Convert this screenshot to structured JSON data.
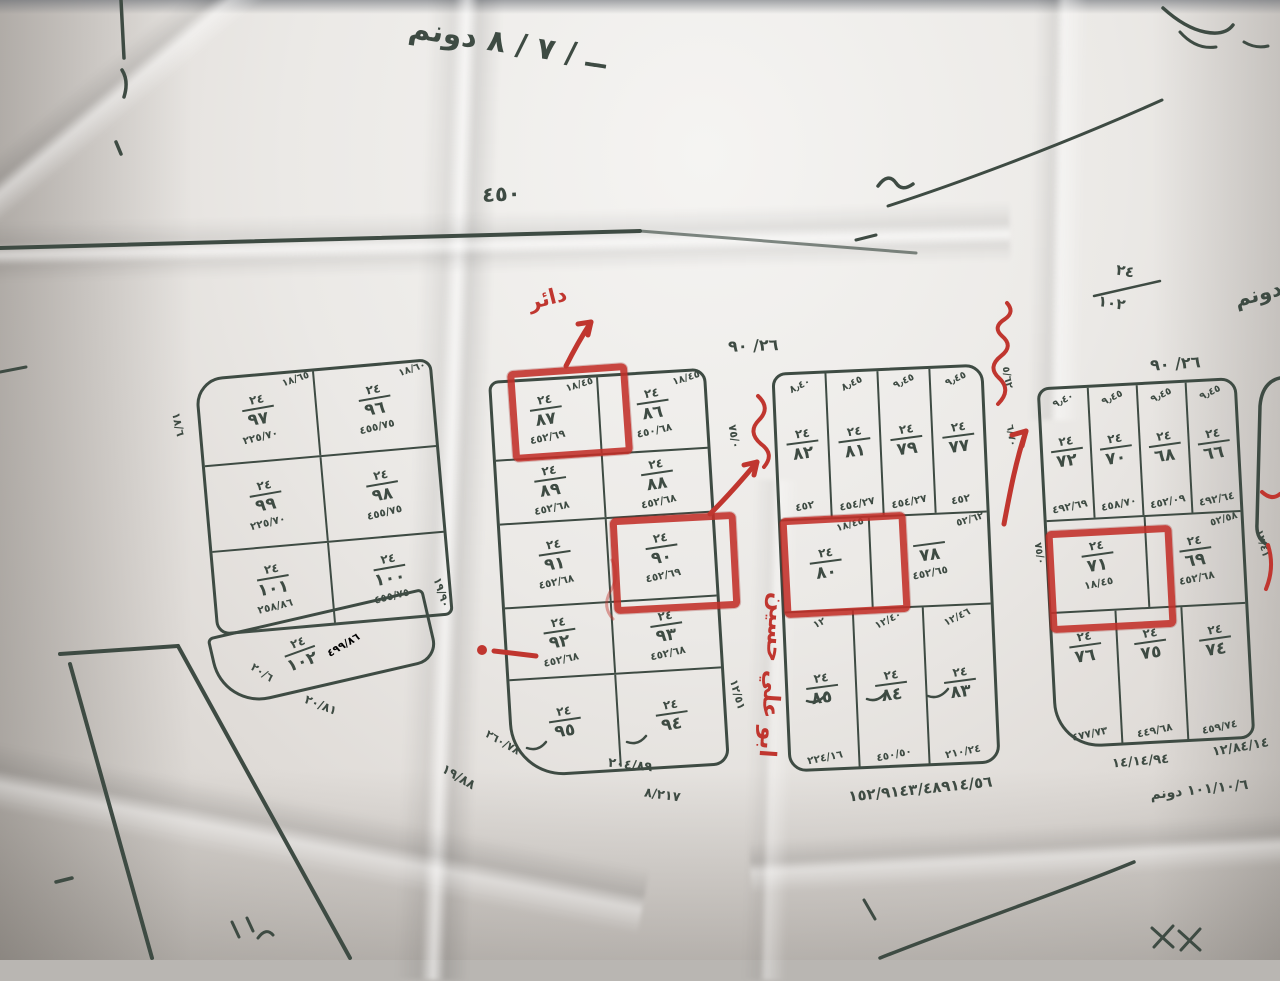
{
  "photo": {
    "paper_color": "#ebe9e6",
    "ink_color": "#3e4b43",
    "marker_color": "#c0362f"
  },
  "top_notes": {
    "dunum_note": "ــ / ٧ / ٨ دونم",
    "road_number": "٤٥٠",
    "corner_fraction_top": "٢٤",
    "corner_fraction_bottom": "١٠٢",
    "dunum_right": "دونم"
  },
  "red_notes": {
    "daer": "دائر",
    "owner_name": "ابو علي حسين"
  },
  "blocks": {
    "a": {
      "cells": [
        {
          "top": "١٨/٦٥",
          "w": "٢٤",
          "n": "٩٧",
          "area": "٢٢٥/٧٠"
        },
        {
          "top": "١٨/٦٠",
          "w": "٢٤",
          "n": "٩٦",
          "area": "٤٥٥/٧٥"
        },
        {
          "top": "",
          "w": "٢٤",
          "n": "٩٩",
          "area": "٢٢٥/٧٠"
        },
        {
          "top": "",
          "w": "٢٤",
          "n": "٩٨",
          "area": "٤٥٥/٧٥"
        },
        {
          "top": "",
          "w": "٢٤",
          "n": "١٠١",
          "area": "٢٥٨/٨٦"
        },
        {
          "top": "",
          "w": "٢٤",
          "n": "١٠٠",
          "area": "٤٥٥/٧٥"
        }
      ],
      "bottom_cell": {
        "w": "٢٤",
        "n": "١٠٢",
        "area": "٤٩٩/٨٦"
      },
      "margins": {
        "left_v": "١٨/٦",
        "right_v": "١٩/٩٠",
        "bottom_1": "٢٠/٦",
        "bottom_2": "٢٠/٨١"
      }
    },
    "b": {
      "cells": [
        {
          "top": "١٨/٤٥",
          "w": "٢٤",
          "n": "٨٧",
          "area": "٤٥٢/٦٩"
        },
        {
          "top": "١٨/٤٥",
          "w": "٢٤",
          "n": "٨٦",
          "area": "٤٥٠/٦٨"
        },
        {
          "top": "",
          "w": "٢٤",
          "n": "٨٩",
          "area": "٤٥٢/٦٨"
        },
        {
          "top": "",
          "w": "٢٤",
          "n": "٨٨",
          "area": "٤٥٢/٦٨"
        },
        {
          "top": "",
          "w": "٢٤",
          "n": "٩١",
          "area": "٤٥٢/٦٨"
        },
        {
          "top": "",
          "w": "٢٤",
          "n": "٩٠",
          "area": "٤٥٢/٦٩"
        },
        {
          "top": "",
          "w": "٢٤",
          "n": "٩٢",
          "area": "٤٥٢/٦٨"
        },
        {
          "top": "",
          "w": "٢٤",
          "n": "٩٣",
          "area": "٤٥٢/٦٨"
        },
        {
          "top": "",
          "w": "٢٤",
          "n": "٩٥",
          "area": ""
        },
        {
          "top": "",
          "w": "٢٤",
          "n": "٩٤",
          "area": ""
        }
      ],
      "margins": {
        "right_top": "٧٥/٠",
        "right_bottom": "١٢/٥١",
        "bottom_left_1": "٢٦٠/٧٨",
        "bottom_left_2": "١٩/٨٨",
        "bottom_1": "٢٠٤/٨٩",
        "bottom_2": "٨/٢١٧"
      }
    },
    "c": {
      "title": "٢٦/ ٩٠",
      "top_cols": [
        {
          "top": "٨٫٤٠",
          "w": "٢٤",
          "n": "٨٢",
          "area": "٤٥٢"
        },
        {
          "top": "٨٫٤٥",
          "w": "٢٤",
          "n": "٨١",
          "area": "٤٥٤/٢٧"
        },
        {
          "top": "٩٫٤٥",
          "w": "٢٤",
          "n": "٧٩",
          "area": "٤٥٤/٢٧"
        },
        {
          "top": "٩٫٤٥",
          "w": "٢٤",
          "n": "٧٧",
          "area": "٤٥٢"
        }
      ],
      "mid": [
        {
          "top": "١٨/٤٥",
          "w": "٢٤",
          "n": "٨٠",
          "area": ""
        },
        {
          "top": "٥٢/٦٢",
          "w": "",
          "n": "٧٨",
          "area": "٤٥٢/٦٥"
        }
      ],
      "bottom_cols": [
        {
          "top": "١٢",
          "w": "٢٤",
          "n": "٨٥",
          "area": "٢٢٤/١٦"
        },
        {
          "top": "١٢/٤٠",
          "w": "٢٤",
          "n": "٨٤",
          "area": "٤٥٠/٥٠"
        },
        {
          "top": "١٢/٤٦",
          "w": "٢٤",
          "n": "٨٣",
          "area": "٢١٠/٢٤"
        }
      ],
      "margins": {
        "right_1": "٥/٦٢",
        "right_2": "٦/٧٠",
        "bottom_line": "١٥٢/٩١٤٣/٤٨٩١٤/٥٦"
      }
    },
    "d": {
      "title": "٢٦/ ٩٠",
      "top_cols": [
        {
          "top": "٩٫٤٠",
          "w": "٢٤",
          "n": "٧٢",
          "area": "٤٩٢/٦٩"
        },
        {
          "top": "٩٫٤٥",
          "w": "٢٤",
          "n": "٧٠",
          "area": "٤٥٨/٧٠"
        },
        {
          "top": "٩٫٤٥",
          "w": "٢٤",
          "n": "٦٨",
          "area": "٤٥٢/٠٩"
        },
        {
          "top": "٩٫٤٥",
          "w": "٢٤",
          "n": "٦٦",
          "area": "٤٩٢/٦٤"
        }
      ],
      "mid": [
        {
          "top": "١٨/٤٥",
          "w": "٢٤",
          "n": "٧١",
          "area": ""
        },
        {
          "top": "٥٢/٥٨",
          "w": "٢٤",
          "n": "٦٩",
          "area": "٤٥٢/٦٨"
        }
      ],
      "bottom_cols": [
        {
          "top": "",
          "w": "٢٤",
          "n": "٧٦",
          "area": "٤٧٧/٧٣"
        },
        {
          "top": "",
          "w": "٢٤",
          "n": "٧٥",
          "area": "٤٤٩/٦٨"
        },
        {
          "top": "",
          "w": "٢٤",
          "n": "٧٤",
          "area": "٤٥٩/٧٤"
        }
      ],
      "margins": {
        "left_v": "٧٥/٠",
        "right_v": "١٢/٤١",
        "bottom_1": "١٤/١٤/٩٤",
        "bottom_2": "١٢/٨٤/١٤",
        "bottom_3": "١٠١/١٠/٦ دونم"
      }
    }
  }
}
